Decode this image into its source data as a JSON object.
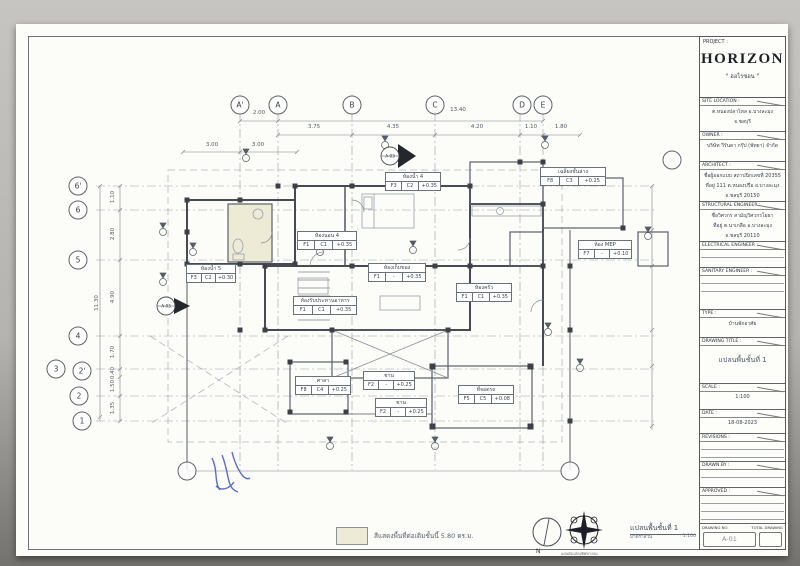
{
  "sheet": {
    "title_block": {
      "project_label": "PROJECT :",
      "project_name": "HORIZON",
      "project_name_thai": "\" ฮอไรซอน \"",
      "sections": [
        {
          "label": "SITE LOCATION :",
          "h": 34,
          "lines": [
            "ต.หนองปลาไหล อ.บางละมุง",
            "จ.ชลบุรี"
          ]
        },
        {
          "label": "OWNER :",
          "h": 30,
          "lines": [
            "บริษัท วีรันดา กรุ๊ป (พัทยา) จำกัด"
          ]
        },
        {
          "label": "ARCHITECT :",
          "h": 40,
          "lines": [
            "ชื่อผู้ออกแบบ สถาปนิกเลขที่ 20355",
            "ที่อยู่ 111 ต.หนองปรือ อ.บางละมุง",
            "จ.ชลบุรี 20150"
          ]
        },
        {
          "label": "STRUCTURAL ENGINEER :",
          "h": 40,
          "lines": [
            "ชื่อวิศวกร สามัญวิศวกรโยธา",
            "ที่อยู่ ต.นาเกลือ อ.บางละมุง",
            "จ.ชลบุรี 20110"
          ]
        },
        {
          "label": "ELECTRICAL ENGINEER :",
          "h": 26,
          "lines": [],
          "rules": 1
        },
        {
          "label": "SANITARY ENGINEER :",
          "h": 42,
          "lines": [],
          "rules": 2
        },
        {
          "label": "TYPE :",
          "h": 28,
          "lines": [
            "บ้านพักอาศัย"
          ]
        },
        {
          "label": "DRAWING TITLE :",
          "h": 46,
          "big": true,
          "lines": [
            "แปลนพื้นชั้นที่ 1"
          ]
        },
        {
          "label": "SCALE :",
          "h": 26,
          "lines": [
            "1:100"
          ]
        },
        {
          "label": "DATE :",
          "h": 24,
          "lines": [
            "18-08-2023"
          ]
        },
        {
          "label": "REVISIONS :",
          "h": 28,
          "lines": [],
          "rules": 2
        },
        {
          "label": "DRAWN BY :",
          "h": 26,
          "lines": [],
          "rules": 1
        },
        {
          "label": "APPROVED :",
          "h": 36,
          "lines": [],
          "rules": 3
        }
      ],
      "drawing_no_label": "DRAWING NO.",
      "total_drawing_label": "TOTAL DRAWING",
      "drawing_no": "A-01",
      "total_drawing": ""
    }
  },
  "plan": {
    "bubbles": [
      {
        "label": "A'",
        "x": 240,
        "y": 105
      },
      {
        "label": "A",
        "x": 278,
        "y": 105
      },
      {
        "label": "B",
        "x": 352,
        "y": 105
      },
      {
        "label": "C",
        "x": 435,
        "y": 105
      },
      {
        "label": "D",
        "x": 522,
        "y": 105
      },
      {
        "label": "E",
        "x": 543,
        "y": 105
      },
      {
        "label": "6'",
        "x": 78,
        "y": 186
      },
      {
        "label": "6",
        "x": 78,
        "y": 210
      },
      {
        "label": "5",
        "x": 78,
        "y": 260
      },
      {
        "label": "4",
        "x": 78,
        "y": 336
      },
      {
        "label": "3",
        "x": 56,
        "y": 369
      },
      {
        "label": "2'",
        "x": 82,
        "y": 371
      },
      {
        "label": "2",
        "x": 79,
        "y": 396
      },
      {
        "label": "1",
        "x": 82,
        "y": 421
      },
      {
        "label": "",
        "x": 672,
        "y": 160
      },
      {
        "label": "",
        "x": 187,
        "y": 471
      },
      {
        "label": "",
        "x": 570,
        "y": 471
      }
    ],
    "dims": [
      {
        "t": "2.00",
        "x": 259,
        "y": 116
      },
      {
        "t": "13.40",
        "x": 458,
        "y": 113
      },
      {
        "t": "3.75",
        "x": 314,
        "y": 130
      },
      {
        "t": "4.35",
        "x": 393,
        "y": 130
      },
      {
        "t": "4.20",
        "x": 477,
        "y": 130
      },
      {
        "t": "1.10",
        "x": 531,
        "y": 130
      },
      {
        "t": "1.80",
        "x": 561,
        "y": 130
      },
      {
        "t": "3.00",
        "x": 212,
        "y": 148
      },
      {
        "t": "3.00",
        "x": 258,
        "y": 148
      },
      {
        "t": "11.30",
        "x": 97,
        "y": 303,
        "rot": true
      },
      {
        "t": "1.10",
        "x": 113,
        "y": 197,
        "rot": true
      },
      {
        "t": "2.80",
        "x": 113,
        "y": 234,
        "rot": true
      },
      {
        "t": "4.90",
        "x": 113,
        "y": 297,
        "rot": true
      },
      {
        "t": "1.70",
        "x": 113,
        "y": 352,
        "rot": true
      },
      {
        "t": "0.40",
        "x": 113,
        "y": 373,
        "rot": true
      },
      {
        "t": "1.50",
        "x": 113,
        "y": 386,
        "rot": true
      },
      {
        "t": "1.35",
        "x": 113,
        "y": 408,
        "rot": true
      }
    ],
    "rooms": [
      {
        "name": "ห้องน้ำ 5",
        "cells": [
          "F3",
          "C2",
          "+0.30"
        ],
        "x": 186,
        "y": 264,
        "w": 48
      },
      {
        "name": "ห้องนอน 4",
        "cells": [
          "F1",
          "C1",
          "+0.35"
        ],
        "x": 297,
        "y": 231,
        "w": 58
      },
      {
        "name": "ห้องน้ำ 4",
        "cells": [
          "F3",
          "C2",
          "+0.35"
        ],
        "x": 385,
        "y": 172,
        "w": 54
      },
      {
        "name": "เฉลียงชั้นล่าง",
        "cells": [
          "F8",
          "C3",
          "+0.25"
        ],
        "x": 540,
        "y": 167,
        "w": 64
      },
      {
        "name": "ห้องเก็บของ",
        "cells": [
          "F1",
          "-",
          "+0.35"
        ],
        "x": 368,
        "y": 263,
        "w": 56
      },
      {
        "name": "ห้องครัว",
        "cells": [
          "F1",
          "C1",
          "+0.35"
        ],
        "x": 456,
        "y": 283,
        "w": 54
      },
      {
        "name": "ห้องรับประทานอาหาร",
        "cells": [
          "F1",
          "C1",
          "+0.35"
        ],
        "x": 293,
        "y": 296,
        "w": 62
      },
      {
        "name": "ห้อง MEP",
        "cells": [
          "F7",
          "-",
          "+0.10"
        ],
        "x": 578,
        "y": 240,
        "w": 52
      },
      {
        "name": "ศาลา",
        "cells": [
          "F8",
          "C4",
          "+0.25"
        ],
        "x": 295,
        "y": 376,
        "w": 54
      },
      {
        "name": "ชาน",
        "cells": [
          "F2",
          "-",
          "+0.25"
        ],
        "x": 363,
        "y": 371,
        "w": 50
      },
      {
        "name": "ชาน",
        "cells": [
          "F2",
          "-",
          "+0.25"
        ],
        "x": 375,
        "y": 398,
        "w": 50
      },
      {
        "name": "ที่จอดรถ",
        "cells": [
          "F5",
          "C5",
          "+0.08"
        ],
        "x": 458,
        "y": 385,
        "w": 54
      }
    ],
    "markers": [
      {
        "label": "A-03",
        "x": 390,
        "y": 156
      },
      {
        "label": "A-03",
        "x": 166,
        "y": 306
      }
    ],
    "notes": {
      "legend_note": "สีแสดงพื้นที่ต่อเติมชั้นนี้ 5.80 ตร.ม.",
      "plan_title": "แปลนพื้นชั้นที่ 1",
      "plan_scale_label": "มาตราส่วน",
      "plan_scale": "1:100",
      "north_label": "N",
      "compass_caption": "แผนผังแสดงทิศทางลม"
    }
  }
}
